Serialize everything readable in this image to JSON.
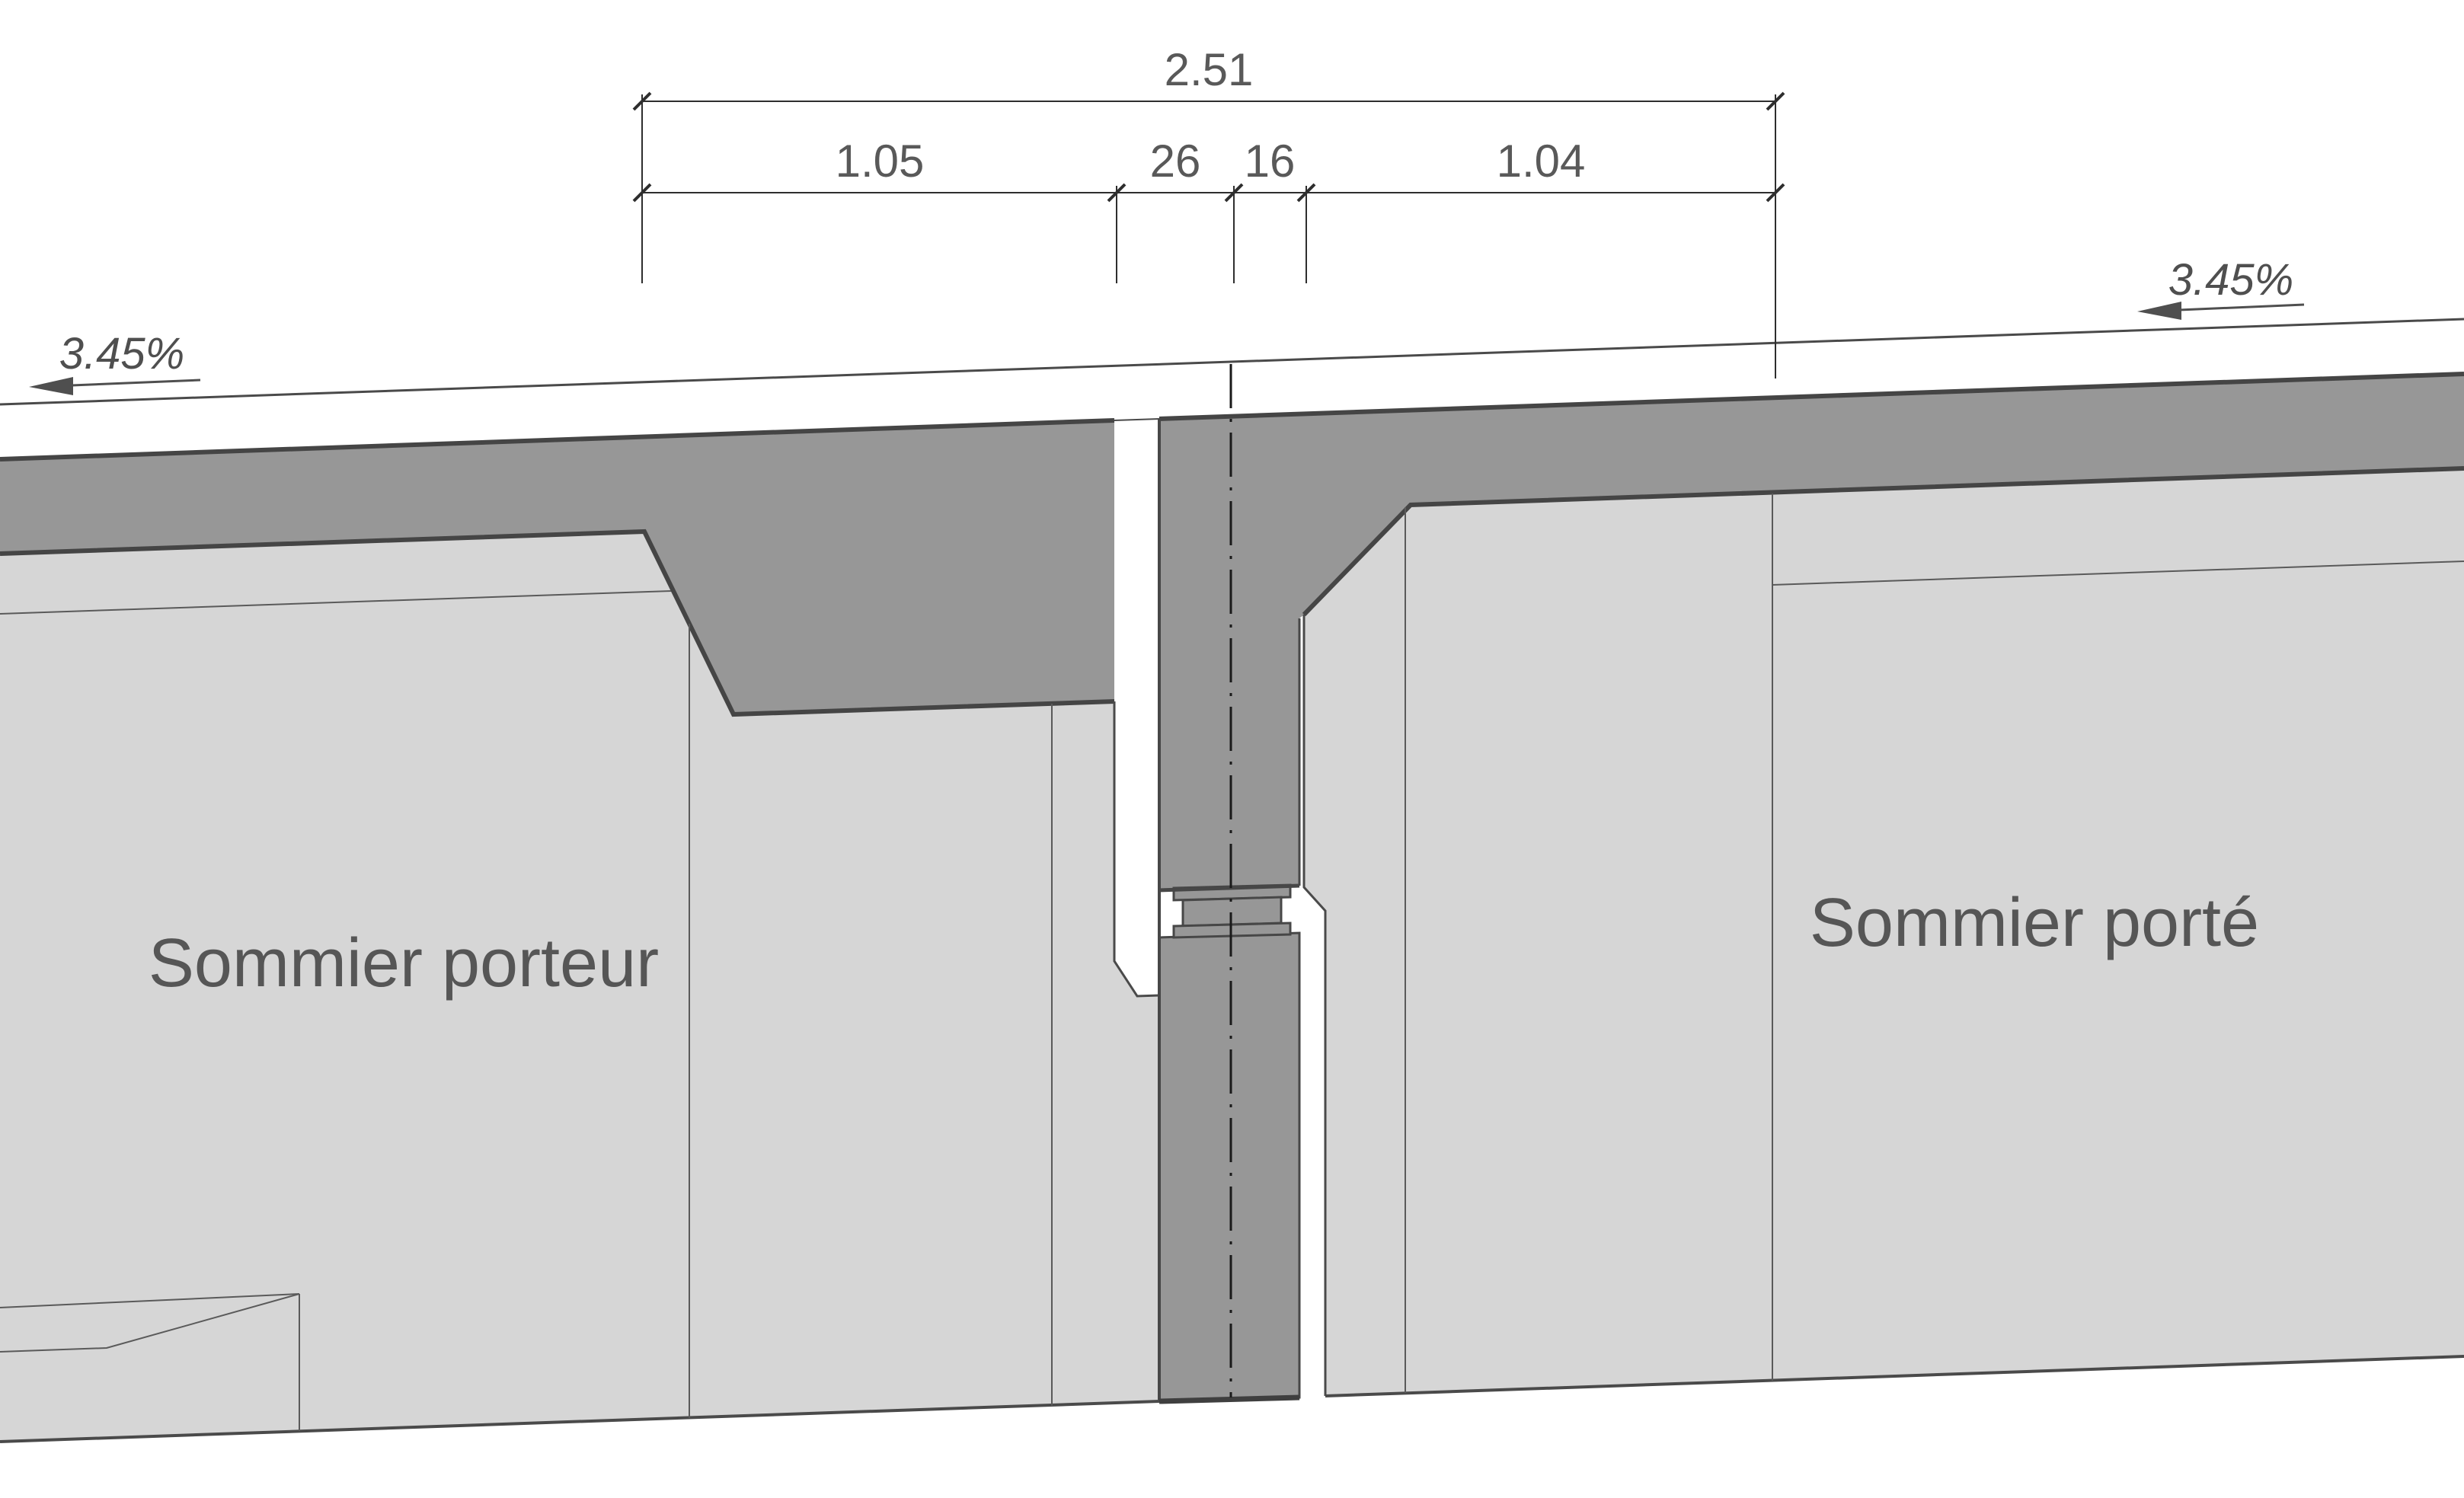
{
  "drawing": {
    "type": "structural-section-detail",
    "dimensions": {
      "total": "2.51",
      "seg_left": "1.05",
      "seg_mid1": "26",
      "seg_mid2": "16",
      "seg_right": "1.04"
    },
    "slopes": {
      "left": "3.45%",
      "right": "3.45%"
    },
    "labels": {
      "left_beam": "Sommier porteur",
      "right_beam": "Sommier porté"
    },
    "colors": {
      "concrete_light": "#d6d6d6",
      "concrete_dark": "#979797",
      "line": "#474747",
      "text": "#565656",
      "background": "#ffffff"
    }
  }
}
